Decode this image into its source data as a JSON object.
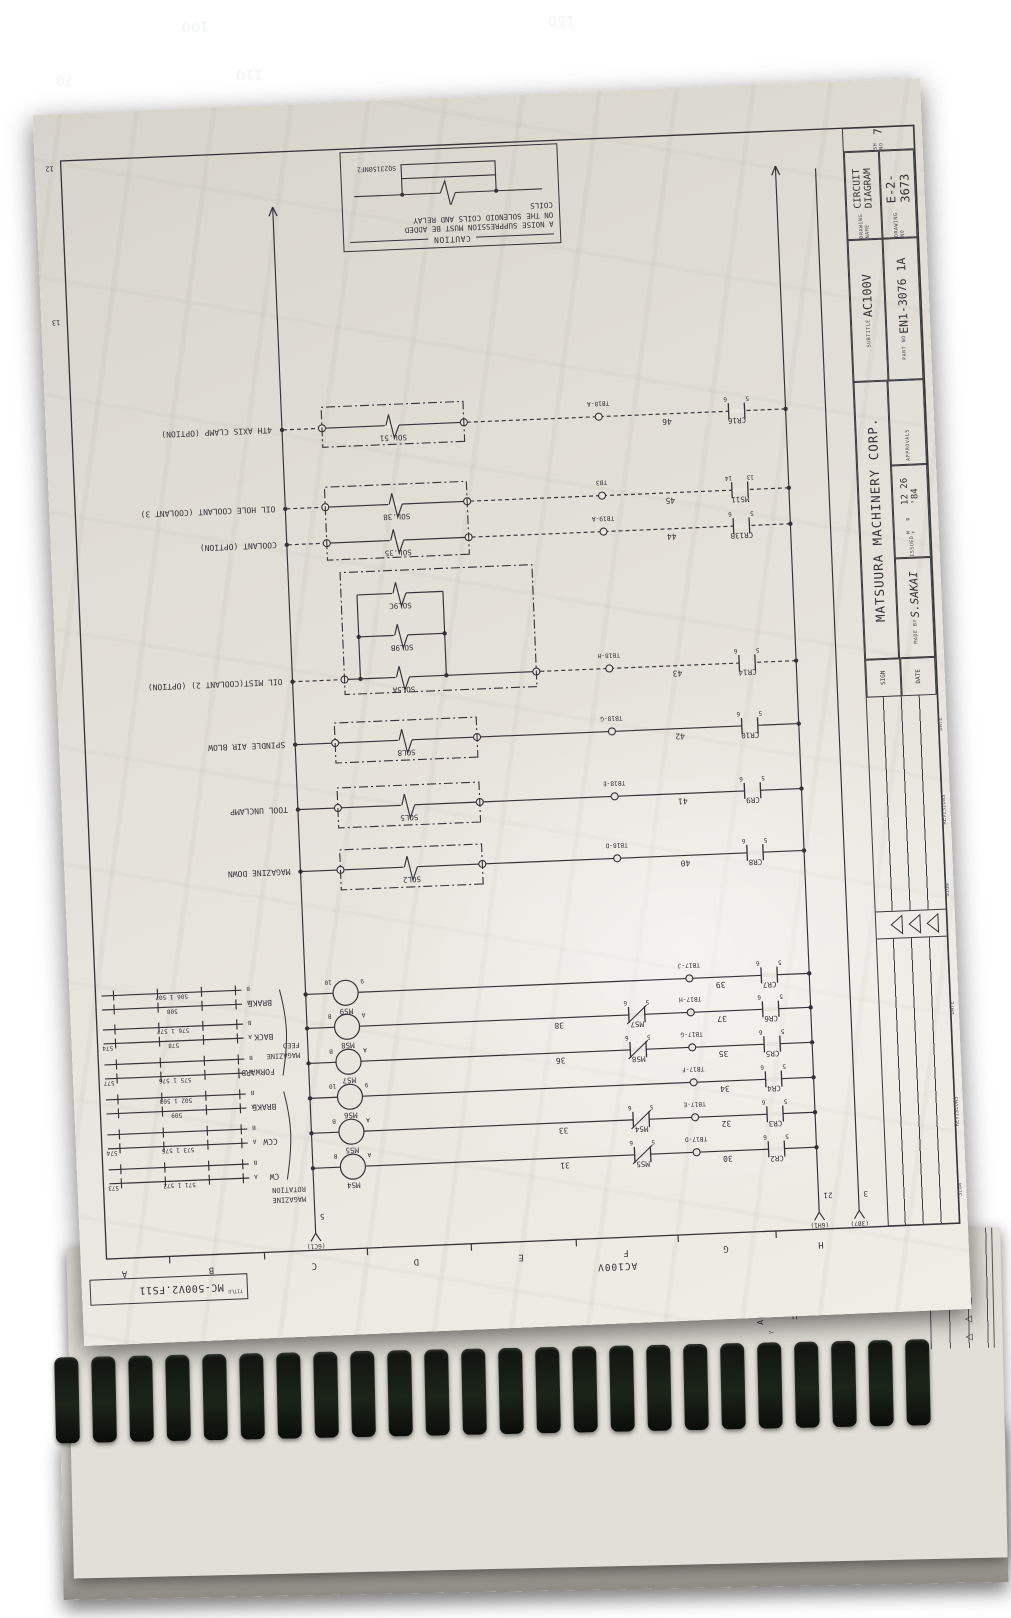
{
  "mat": {
    "numbers": [
      "100",
      "110",
      "150",
      "70"
    ]
  },
  "page": {
    "grid_letters": [
      "H",
      "G",
      "F",
      "E",
      "D",
      "C",
      "B",
      "A"
    ],
    "grid_numbers": [
      "13",
      "12"
    ],
    "file_box": {
      "label": "TITLE",
      "value": "MC-500V2.FS11"
    },
    "supply": {
      "label": "AC100V",
      "feeds": [
        {
          "wire": "3",
          "ref": "(3B7)"
        },
        {
          "wire": "21",
          "ref": "(6H1)"
        },
        {
          "wire": "5",
          "ref": "(6C1)"
        }
      ]
    },
    "caution": {
      "title": "CAUTION",
      "lines": [
        "A NOISE SUPPRESSION MUST BE ADDED",
        "ON THE SOLENOID COILS AND RELAY",
        "COILS"
      ],
      "part": "SQ23150NF2"
    },
    "title_block": {
      "margin_labels": [
        "SIGN",
        "REVISIONS",
        "DATE",
        "SIGN",
        "REVISIONS",
        "DATE"
      ],
      "date_label": "DATE",
      "sign_label": "SIGN",
      "company": "MATSUURA MACHINERY CORP.",
      "made_by_label": "MADE BY",
      "made_by": "S.SAKAI",
      "issued_label": "ISSUED",
      "issued_units": "M  D  Y",
      "issued": "12 26 '84",
      "approvals_label": "APPROVALS",
      "subtitle_label": "SUBTITLE",
      "subtitle": "AC100V",
      "part_no_label": "PART NO",
      "part_no": "EN1-3076 1A",
      "drawing_name_label": "DRAWING NAME",
      "drawing_name": "CIRCUIT DIAGRAM",
      "drawing_no_label": "DRAWING NO",
      "drawing_no": "E-2-3673",
      "sheet_label": "SH NO",
      "sheet_no": "7"
    },
    "groups": [
      {
        "lines": [
          "MAGAZINE",
          "ROTATION"
        ]
      },
      {
        "lines": [
          "MAGAZINE",
          "FEED"
        ]
      }
    ],
    "motor_rungs": [
      {
        "relay": "CR2",
        "pins": [
          "5",
          "6"
        ],
        "num": "30",
        "tb": "TB17-D",
        "interlock": "MS5",
        "interlock_pins": [
          "5",
          "6"
        ],
        "num2": "31",
        "coil": "MS4",
        "coil_pins": [
          "A",
          "B"
        ],
        "label": "CW",
        "aux_top": "571 1 572",
        "aux_bottom": "",
        "aux_far": "573"
      },
      {
        "relay": "CR3",
        "pins": [
          "5",
          "6"
        ],
        "num": "32",
        "tb": "TB17-E",
        "interlock": "MS4",
        "interlock_pins": [
          "5",
          "6"
        ],
        "num2": "33",
        "coil": "MS5",
        "coil_pins": [
          "A",
          "B"
        ],
        "label": "CCW",
        "aux_top": "573 1 575",
        "aux_bottom": "",
        "aux_far": "574"
      },
      {
        "relay": "CR4",
        "pins": [
          "5",
          "6"
        ],
        "num": "34",
        "tb": "TB17-F",
        "interlock": "",
        "interlock_pins": [
          "",
          ""
        ],
        "num2": "",
        "coil": "MS6",
        "coil_pins": [
          "9",
          "10"
        ],
        "label": "BRAKE",
        "aux_top": "509",
        "aux_bottom": "502 1 503",
        "aux_far": ""
      },
      {
        "relay": "CR5",
        "pins": [
          "5",
          "6"
        ],
        "num": "35",
        "tb": "TB17-G",
        "interlock": "MS8",
        "interlock_pins": [
          "5",
          "6"
        ],
        "num2": "36",
        "coil": "MS7",
        "coil_pins": [
          "A",
          "B"
        ],
        "label": "FORWARD",
        "aux_top": "575 1 576",
        "aux_bottom": "",
        "aux_far": "577"
      },
      {
        "relay": "CR6",
        "pins": [
          "5",
          "6"
        ],
        "num": "37",
        "tb": "TB17-H",
        "interlock": "MS7",
        "interlock_pins": [
          "5",
          "6"
        ],
        "num2": "38",
        "coil": "MS8",
        "coil_pins": [
          "A",
          "B"
        ],
        "label": "BACK",
        "aux_top": "578",
        "aux_bottom": "576 1 577",
        "aux_far": "574"
      },
      {
        "relay": "CR7",
        "pins": [
          "5",
          "6"
        ],
        "num": "39",
        "tb": "TB17-J",
        "interlock": "",
        "interlock_pins": [
          "",
          ""
        ],
        "num2": "",
        "coil": "MS9",
        "coil_pins": [
          "9",
          "10"
        ],
        "label": "BRAKE",
        "aux_top": "508",
        "aux_bottom": "506 1 507",
        "aux_far": ""
      }
    ],
    "sol_rungs": [
      {
        "relay": "CR8",
        "pins": [
          "5",
          "6"
        ],
        "num": "40",
        "tb": "TB18-D",
        "sol": "SOL2",
        "label": "MAGAZINE DOWN",
        "dashed": false
      },
      {
        "relay": "CR9",
        "pins": [
          "5",
          "6"
        ],
        "num": "41",
        "tb": "TB18-E",
        "sol": "SOL5",
        "label": "TOOL UNCLAMP",
        "dashed": false
      },
      {
        "relay": "CR10",
        "pins": [
          "5",
          "6"
        ],
        "num": "42",
        "tb": "TB18-G",
        "sol": "SOL8",
        "label": "SPINDLE AIR BLOW",
        "dashed": false
      },
      {
        "relay": "CR14",
        "pins": [
          "5",
          "6"
        ],
        "num": "43",
        "tb": "TB18-H",
        "sol": "SOL5A",
        "extra_sols": [
          "SOL9B",
          "SOL9C"
        ],
        "label": "OIL MIST(COOLANT 2) (OPTION)",
        "dashed": true
      },
      {
        "relay": "CR13B",
        "pins": [
          "5",
          "6"
        ],
        "num": "44",
        "tb": "TB19-A",
        "sol": "SOL.35",
        "label": "COOLANT (OPTION)",
        "dashed": true
      },
      {
        "relay": "MS11",
        "pins": [
          "13",
          "14"
        ],
        "num": "45",
        "tb": "TB3",
        "sol": "SOL.38",
        "label": "OIL HOLE COOLANT (COOLANT 3)",
        "dashed": true
      },
      {
        "relay": "CR16",
        "pins": [
          "5",
          "6"
        ],
        "num": "46",
        "tb": "TB18-A",
        "sol": "SOL.51",
        "label": "4TH AXIS CLAMP (OPTION)",
        "dashed": true
      }
    ]
  },
  "next_page": {
    "subtitle": "AP CARD",
    "units": "M D Y",
    "letters": [
      "G",
      "H"
    ]
  }
}
